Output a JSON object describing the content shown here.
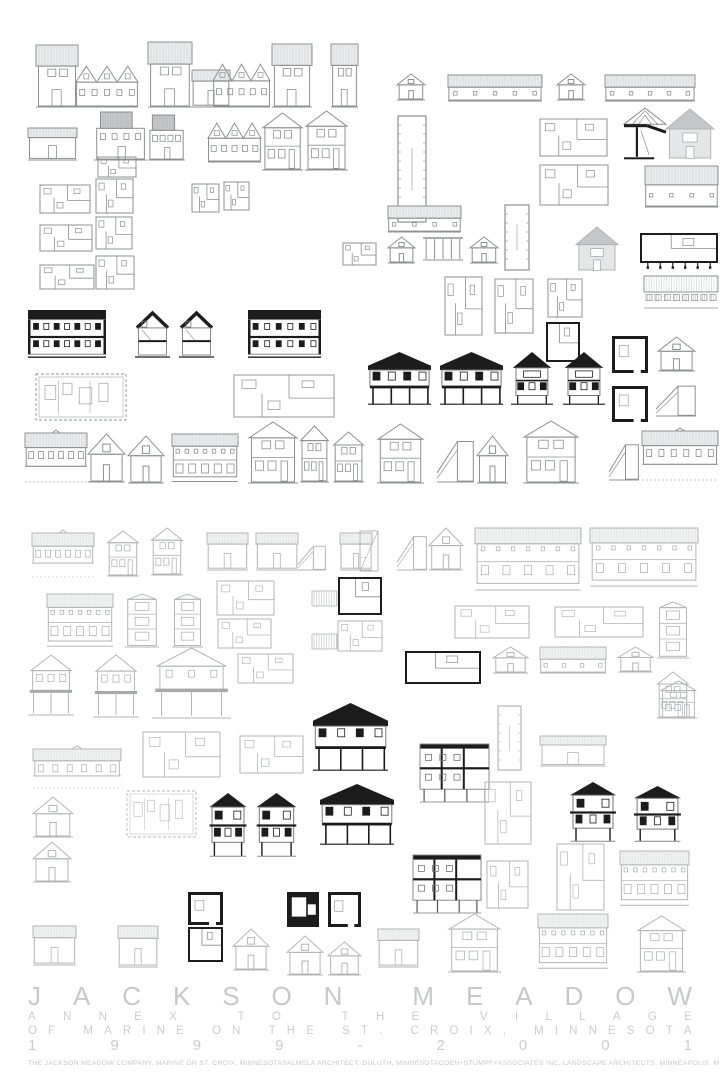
{
  "poster": {
    "title": "JACKSON MEADOW",
    "subtitle1": "ANNEX TO THE VILLAGE",
    "subtitle2": "OF MARINE ON THE ST. CROIX, MINNESOTA",
    "years": "1999-2001",
    "credits": [
      "THE JACKSON MEADOW COMPANY, MARINE ON ST. CROIX, MINNESOTA",
      "SALMELA ARCHITECT, DULUTH, MINNESOTA",
      "COEN+STUMPF+ASSOCIATES INC, LANDSCAPE ARCHITECTS, MINNEAPOLIS, MINNESOTA"
    ]
  },
  "colors": {
    "background": "#ffffff",
    "line_dark": "#8e9093",
    "line_light": "#b4b6b8",
    "ink": "#1c1c1c",
    "roof_gray": "#c3c7c9",
    "stripe_dark": "#c6c8c9",
    "stripe_light": "#d8dadb",
    "title_text": "#c7c9c9",
    "credits_text": "#c6c8c8"
  },
  "drawings": [
    [
      "th",
      36,
      45,
      42,
      62
    ],
    [
      "tg",
      76,
      64,
      62,
      43
    ],
    [
      "th",
      148,
      42,
      44,
      65
    ],
    [
      "fs",
      192,
      70,
      38,
      37
    ],
    [
      "tg",
      213,
      62,
      57,
      45
    ],
    [
      "th",
      272,
      44,
      40,
      63
    ],
    [
      "th",
      331,
      44,
      27,
      63
    ],
    [
      "g1",
      397,
      74,
      28,
      26
    ],
    [
      "lb",
      448,
      74,
      94,
      27
    ],
    [
      "g1",
      557,
      74,
      28,
      26
    ],
    [
      "lb",
      605,
      74,
      90,
      27
    ],
    [
      "fs",
      28,
      128,
      49,
      32
    ],
    [
      "gb",
      94,
      112,
      53,
      48
    ],
    [
      "gb",
      148,
      115,
      37,
      45
    ],
    [
      "tg",
      208,
      121,
      53,
      41
    ],
    [
      "g2",
      262,
      113,
      41,
      57
    ],
    [
      "g2",
      305,
      111,
      43,
      59
    ],
    [
      "tp",
      398,
      116,
      28,
      106
    ],
    [
      "pl",
      540,
      119,
      67,
      37
    ],
    [
      "ts",
      624,
      106,
      42,
      57
    ],
    [
      "gh",
      666,
      109,
      48,
      50
    ],
    [
      "pl",
      98,
      157,
      38,
      20
    ],
    [
      "pl",
      40,
      185,
      50,
      28
    ],
    [
      "pl",
      96,
      179,
      37,
      34
    ],
    [
      "pl",
      192,
      184,
      27,
      28
    ],
    [
      "pl",
      224,
      182,
      25,
      28
    ],
    [
      "pl",
      40,
      225,
      52,
      26
    ],
    [
      "pl",
      96,
      217,
      36,
      32
    ],
    [
      "pl",
      40,
      265,
      54,
      24
    ],
    [
      "pl",
      96,
      256,
      38,
      33
    ],
    [
      "lb",
      388,
      205,
      73,
      27
    ],
    [
      "tp",
      505,
      205,
      24,
      65
    ],
    [
      "pl",
      540,
      165,
      68,
      40
    ],
    [
      "lb",
      645,
      165,
      73,
      42
    ],
    [
      "pl",
      343,
      243,
      33,
      22
    ],
    [
      "g1",
      388,
      237,
      27,
      26
    ],
    [
      "sp",
      423,
      236,
      40,
      25
    ],
    [
      "g1",
      470,
      237,
      28,
      26
    ],
    [
      "gh",
      576,
      227,
      42,
      44
    ],
    [
      "plb",
      640,
      233,
      78,
      36,
      1
    ],
    [
      "gp",
      644,
      276,
      74,
      32
    ],
    [
      "pl",
      445,
      277,
      37,
      58
    ],
    [
      "pl",
      495,
      279,
      38,
      54
    ],
    [
      "pl",
      548,
      279,
      34,
      38
    ],
    [
      "plb",
      546,
      322,
      34,
      40
    ],
    [
      "sl",
      28,
      310,
      78,
      48
    ],
    [
      "sg",
      135,
      311,
      35,
      47
    ],
    [
      "sg",
      179,
      311,
      35,
      47
    ],
    [
      "sl",
      248,
      310,
      73,
      48
    ],
    [
      "be",
      368,
      352,
      63,
      53
    ],
    [
      "be",
      440,
      352,
      63,
      53
    ],
    [
      "bg",
      511,
      352,
      42,
      53
    ],
    [
      "bg",
      563,
      352,
      42,
      53
    ],
    [
      "sq",
      612,
      336,
      36,
      37
    ],
    [
      "sq",
      612,
      386,
      36,
      36
    ],
    [
      "g1",
      658,
      337,
      37,
      34
    ],
    [
      "ss",
      656,
      382,
      40,
      34
    ],
    [
      "bp",
      36,
      374,
      90,
      46
    ],
    [
      "pl",
      234,
      375,
      100,
      42
    ],
    [
      "lh",
      25,
      430,
      62,
      52
    ],
    [
      "g1",
      88,
      434,
      37,
      48
    ],
    [
      "g1",
      128,
      436,
      36,
      47
    ],
    [
      "lh2",
      172,
      432,
      66,
      51
    ],
    [
      "g2",
      248,
      422,
      50,
      61
    ],
    [
      "g2",
      300,
      426,
      29,
      56
    ],
    [
      "g2",
      333,
      432,
      31,
      50
    ],
    [
      "g2",
      377,
      424,
      47,
      59
    ],
    [
      "ss",
      437,
      436,
      37,
      46
    ],
    [
      "g1",
      477,
      436,
      31,
      47
    ],
    [
      "g2",
      523,
      421,
      56,
      62
    ],
    [
      "ss",
      609,
      440,
      30,
      40
    ],
    [
      "lh",
      642,
      428,
      76,
      52
    ],
    [
      "lh",
      32,
      530,
      62,
      47
    ],
    [
      "g2",
      107,
      531,
      32,
      45
    ],
    [
      "g2",
      151,
      528,
      32,
      47
    ],
    [
      "fs",
      207,
      533,
      41,
      37
    ],
    [
      "fs",
      256,
      533,
      42,
      37
    ],
    [
      "ss",
      298,
      543,
      28,
      27
    ],
    [
      "fs",
      340,
      533,
      32,
      37
    ],
    [
      "st",
      360,
      531,
      18,
      40
    ],
    [
      "ss",
      397,
      532,
      30,
      38
    ],
    [
      "g1",
      429,
      528,
      34,
      42
    ],
    [
      "lh2",
      475,
      526,
      106,
      66
    ],
    [
      "lh2",
      590,
      526,
      108,
      62
    ],
    [
      "lh2",
      47,
      592,
      66,
      56
    ],
    [
      "tw",
      125,
      594,
      34,
      53
    ],
    [
      "tw",
      172,
      594,
      31,
      53
    ],
    [
      "pl",
      217,
      581,
      57,
      34
    ],
    [
      "pl",
      218,
      619,
      53,
      29
    ],
    [
      "ht",
      312,
      591,
      25,
      15
    ],
    [
      "ht",
      312,
      634,
      25,
      15
    ],
    [
      "plb",
      338,
      577,
      44,
      38
    ],
    [
      "pl",
      338,
      621,
      44,
      30
    ],
    [
      "pl",
      455,
      606,
      74,
      32
    ],
    [
      "pl",
      555,
      607,
      88,
      30
    ],
    [
      "tw",
      657,
      602,
      32,
      56
    ],
    [
      "dh",
      28,
      655,
      46,
      60
    ],
    [
      "dh",
      93,
      655,
      46,
      62
    ],
    [
      "dh",
      152,
      648,
      79,
      70
    ],
    [
      "pl",
      238,
      654,
      55,
      29
    ],
    [
      "plb",
      405,
      651,
      76,
      33
    ],
    [
      "g1",
      493,
      647,
      35,
      26
    ],
    [
      "lb",
      540,
      646,
      66,
      27
    ],
    [
      "g1",
      618,
      647,
      35,
      25
    ],
    [
      "g2",
      657,
      672,
      32,
      46
    ],
    [
      "lh",
      33,
      746,
      88,
      42
    ],
    [
      "pl",
      143,
      732,
      77,
      45
    ],
    [
      "pl",
      240,
      736,
      63,
      37
    ],
    [
      "be",
      313,
      703,
      75,
      68
    ],
    [
      "tp",
      498,
      706,
      23,
      64
    ],
    [
      "fs",
      540,
      736,
      66,
      30
    ],
    [
      "g2",
      660,
      681,
      37,
      37
    ],
    [
      "s2",
      420,
      744,
      69,
      58
    ],
    [
      "be",
      320,
      784,
      74,
      61
    ],
    [
      "g1",
      33,
      797,
      40,
      40
    ],
    [
      "g1",
      33,
      842,
      38,
      40
    ],
    [
      "bp",
      127,
      791,
      69,
      46
    ],
    [
      "b2",
      208,
      793,
      40,
      64
    ],
    [
      "b2",
      255,
      793,
      43,
      64
    ],
    [
      "s2",
      413,
      855,
      68,
      58
    ],
    [
      "pl",
      485,
      782,
      46,
      62
    ],
    [
      "pl",
      487,
      861,
      41,
      47
    ],
    [
      "b2",
      568,
      782,
      50,
      60
    ],
    [
      "b2",
      632,
      786,
      51,
      56
    ],
    [
      "pl",
      557,
      844,
      47,
      66
    ],
    [
      "lh2",
      620,
      849,
      69,
      58
    ],
    [
      "sq",
      188,
      892,
      35,
      33
    ],
    [
      "sq",
      287,
      892,
      32,
      35,
      1
    ],
    [
      "sq",
      328,
      892,
      33,
      35
    ],
    [
      "plb",
      188,
      927,
      35,
      35
    ],
    [
      "fs",
      33,
      926,
      43,
      39
    ],
    [
      "fs",
      118,
      926,
      40,
      41
    ],
    [
      "g1",
      233,
      929,
      36,
      41
    ],
    [
      "g1",
      287,
      936,
      36,
      39
    ],
    [
      "g1",
      328,
      942,
      33,
      33
    ],
    [
      "fs",
      378,
      929,
      41,
      38
    ],
    [
      "g2",
      448,
      914,
      53,
      58
    ],
    [
      "lh2",
      538,
      912,
      70,
      58
    ],
    [
      "g2",
      637,
      916,
      49,
      56
    ]
  ]
}
